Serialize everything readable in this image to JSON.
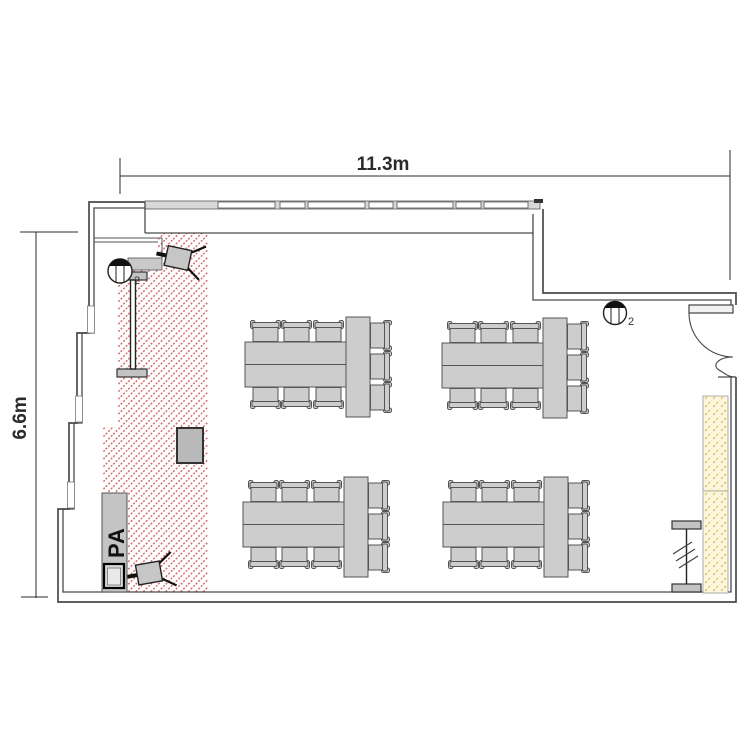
{
  "dimensions": {
    "top": "11.3m",
    "left": "6.6m"
  },
  "labels": {
    "pa_desk": "PA",
    "ceiling_device_left_count": "2",
    "ceiling_device_top_count": "2"
  },
  "colors": {
    "wall": "#4a4a4a",
    "furniture_fill": "#cdcdcd",
    "furniture_stroke": "#555555",
    "hatch_red": "#d96b6b",
    "hatch_yellow": "#dcc659",
    "board_fill": "#fcf7e0",
    "dim_color": "#2b2b2b"
  },
  "inventory": {
    "table_groups": 4,
    "chairs_per_group": 9,
    "floor_speakers": 2,
    "ceiling_devices": 2,
    "doors": 1,
    "screens": 2
  }
}
